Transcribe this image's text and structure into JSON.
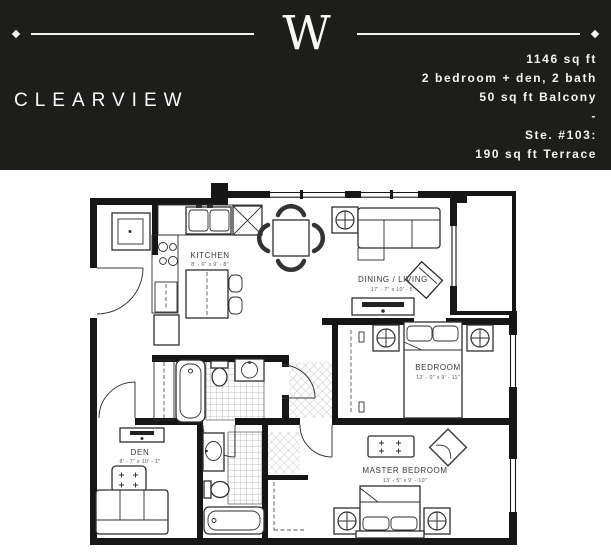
{
  "header": {
    "bg_color": "#1d1d1b",
    "text_color": "#f5f5f3",
    "logo_monogram": "W",
    "plan_name": "CLEARVIEW",
    "specs": [
      "1146 sq ft",
      "2 bedroom + den, 2 bath",
      "50 sq ft Balcony",
      "-",
      "Ste. #103:",
      "190 sq ft Terrace"
    ]
  },
  "floor_plan": {
    "wall_color": "#161616",
    "rooms": [
      {
        "name": "KITCHEN",
        "dims": "8' - 6\" x 9' - 8\""
      },
      {
        "name": "DINING / LIVING",
        "dims": "17' - 7\" x 10' - 5\""
      },
      {
        "name": "BEDROOM",
        "dims": "12' - 0\" x 9' - 11\""
      },
      {
        "name": "DEN",
        "dims": "8' - 7\" x 10' - 1\""
      },
      {
        "name": "MASTER BEDROOM",
        "dims": "13' - 5\" x 9' - 10\""
      }
    ]
  }
}
